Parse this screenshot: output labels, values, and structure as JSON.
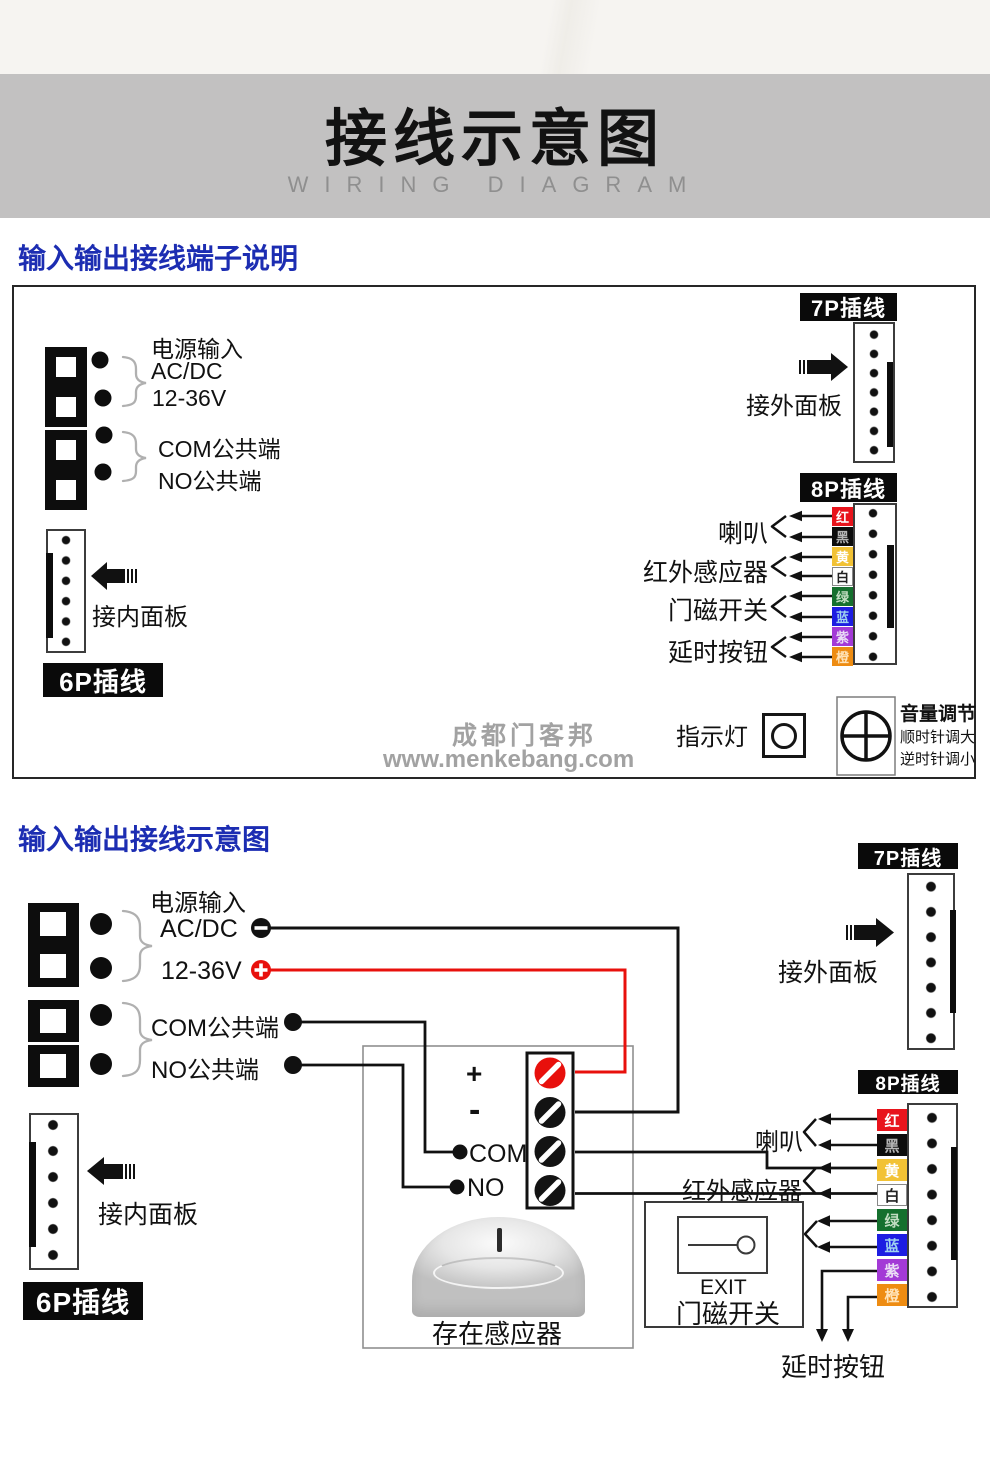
{
  "header": {
    "title": "接线示意图",
    "subtitle": "WIRING DIAGRAM"
  },
  "colors": {
    "accent_blue": "#1c2db2",
    "wire_red": "#e8100c",
    "banner_gray": "#c2c1c1"
  },
  "section1": {
    "heading": "输入输出接线端子说明",
    "terminal": {
      "power": "电源输入",
      "acdc": "AC/DC",
      "voltage": "12-36V",
      "com": "COM公共端",
      "no": "NO公共端"
    },
    "p6": {
      "label": "6P插线",
      "caption": "接内面板"
    },
    "p7": {
      "label": "7P插线",
      "caption": "接外面板"
    },
    "p8": {
      "label": "8P插线",
      "wires": [
        {
          "label": "红",
          "style": "background:#e8141c;color:#ffffff"
        },
        {
          "label": "黑",
          "style": "background:#0d0d0d;color:#b5b5b5"
        },
        {
          "label": "黄",
          "style": "background:#f2c235;color:#ffffff"
        },
        {
          "label": "白",
          "style": "background:#ffffff;color:#222222;box-shadow:inset 0 0 0 1px #888888"
        },
        {
          "label": "绿",
          "style": "background:#15702e;color:#c2ddc2"
        },
        {
          "label": "蓝",
          "style": "background:#1d1de2;color:#9fd2f0"
        },
        {
          "label": "紫",
          "style": "background:#a33ad6;color:#eadcf5"
        },
        {
          "label": "橙",
          "style": "background:#ee8c12;color:#ffe3b8"
        }
      ],
      "functions": [
        "喇叭",
        "红外感应器",
        "门磁开关",
        "延时按钮"
      ]
    },
    "indicator_label": "指示灯",
    "volume": {
      "title": "音量调节",
      "line1": "顺时针调大",
      "line2": "逆时针调小"
    },
    "watermark": {
      "line1": "成都门客邦",
      "line2": "www.menkebang.com"
    }
  },
  "section2": {
    "heading": "输入输出接线示意图",
    "terminal": {
      "power": "电源输入",
      "acdc": "AC/DC",
      "voltage": "12-36V",
      "com": "COM公共端",
      "no": "NO公共端"
    },
    "relay": {
      "plus": "+",
      "minus": "-",
      "com": "COM",
      "no": "NO"
    },
    "sensor_label": "存在感应器",
    "exit_button": {
      "title": "EXIT",
      "label": "门磁开关"
    },
    "p6": {
      "label": "6P插线",
      "caption": "接内面板"
    },
    "p7": {
      "label": "7P插线",
      "caption": "接外面板"
    },
    "p8": {
      "label": "8P插线",
      "wires": [
        {
          "label": "红",
          "style": "background:#e8141c;color:#ffffff"
        },
        {
          "label": "黑",
          "style": "background:#0d0d0d;color:#b5b5b5"
        },
        {
          "label": "黄",
          "style": "background:#f2c235;color:#ffffff"
        },
        {
          "label": "白",
          "style": "background:#ffffff;color:#222222;box-shadow:inset 0 0 0 1px #888888"
        },
        {
          "label": "绿",
          "style": "background:#15702e;color:#c2ddc2"
        },
        {
          "label": "蓝",
          "style": "background:#1d1de2;color:#9fd2f0"
        },
        {
          "label": "紫",
          "style": "background:#a33ad6;color:#eadcf5"
        },
        {
          "label": "橙",
          "style": "background:#ee8c12;color:#ffe3b8"
        }
      ],
      "speaker": "喇叭",
      "ir_sensor": "红外感应器",
      "delay_button": "延时按钮"
    }
  }
}
